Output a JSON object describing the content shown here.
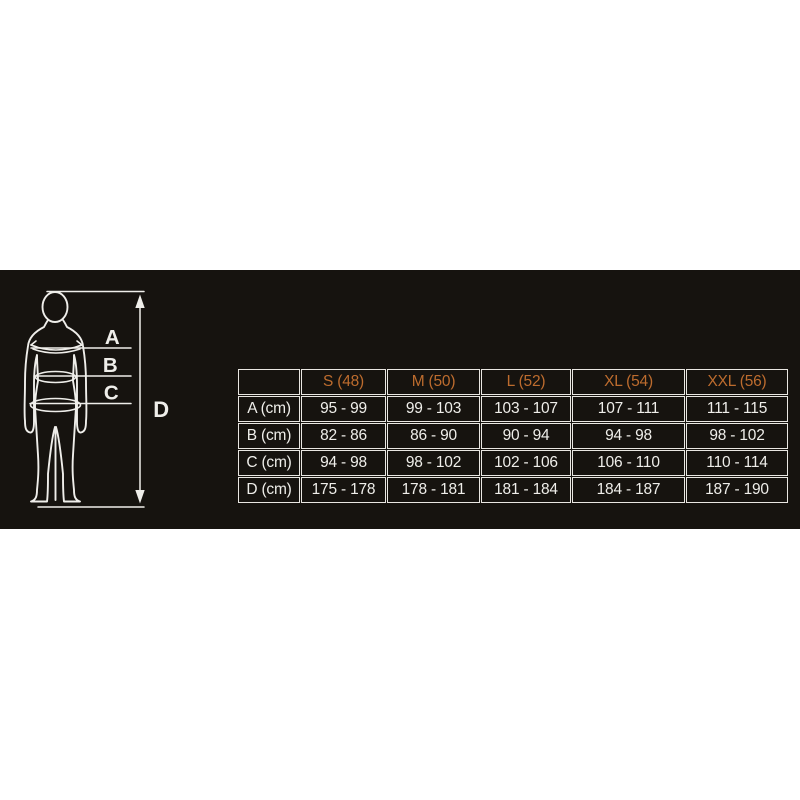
{
  "colors": {
    "page_background": "#ffffff",
    "panel_background": "#16130f",
    "line": "#efeeea",
    "accent_orange": "#bd6c2e"
  },
  "figure": {
    "labels": {
      "a": "A",
      "b": "B",
      "c": "C",
      "d": "D"
    }
  },
  "size_chart": {
    "columns": [
      "",
      "S (48)",
      "M (50)",
      "L (52)",
      "XL (54)",
      "XXL (56)"
    ],
    "rows": [
      {
        "label": "A (cm)",
        "values": [
          "95 - 99",
          "99 - 103",
          "103 - 107",
          "107 - 111",
          "111 - 115"
        ]
      },
      {
        "label": "B (cm)",
        "values": [
          "82 - 86",
          "86 - 90",
          "90 - 94",
          "94 - 98",
          "98 - 102"
        ]
      },
      {
        "label": "C (cm)",
        "values": [
          "94 - 98",
          "98 - 102",
          "102 - 106",
          "106 - 110",
          "110 - 114"
        ]
      },
      {
        "label": "D (cm)",
        "values": [
          "175 - 178",
          "178 - 181",
          "181 - 184",
          "184 - 187",
          "187 - 190"
        ]
      }
    ]
  }
}
